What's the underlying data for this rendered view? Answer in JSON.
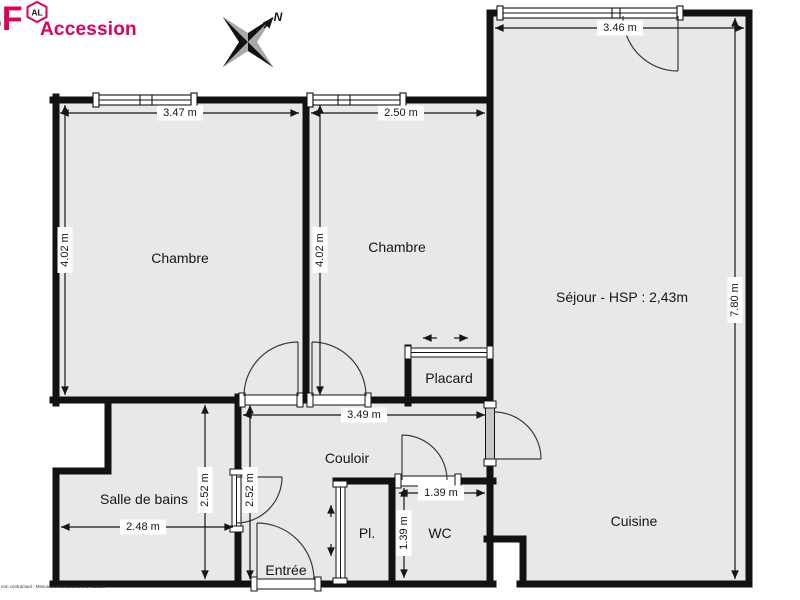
{
  "branding": {
    "logo_main": "3F",
    "badge_text": "AL",
    "subtitle": "Accession",
    "brand_color": "#e0005a"
  },
  "compass": {
    "north_label": "N"
  },
  "footnote": "non contractuel - Mesures et surfaces à titre indicatif",
  "rooms": {
    "chambre1": {
      "label": "Chambre"
    },
    "chambre2": {
      "label": "Chambre"
    },
    "sejour": {
      "label": "Séjour - HSP : 2,43m"
    },
    "placard": {
      "label": "Placard"
    },
    "couloir": {
      "label": "Couloir"
    },
    "sdb": {
      "label": "Salle de bains"
    },
    "entree": {
      "label": "Entrée"
    },
    "pl": {
      "label": "Pl."
    },
    "wc": {
      "label": "WC"
    },
    "cuisine": {
      "label": "Cuisine"
    }
  },
  "dimensions": {
    "chambre1_width": {
      "label": "3.47 m"
    },
    "chambre1_height": {
      "label": "4.02 m"
    },
    "chambre2_width": {
      "label": "2.50 m"
    },
    "chambre2_height": {
      "label": "4.02 m"
    },
    "sejour_width": {
      "label": "3.46 m"
    },
    "sejour_height": {
      "label": "7.80 m"
    },
    "couloir_width": {
      "label": "3.49 m"
    },
    "sdb_width": {
      "label": "2.48 m"
    },
    "sdb_height": {
      "label": "2.52 m"
    },
    "hall_height": {
      "label": "2.52 m"
    },
    "wc_width": {
      "label": "1.39 m"
    },
    "wc_height": {
      "label": "1.39 m"
    }
  },
  "colors": {
    "room_fill": "#e8e8e8",
    "wall": "#121212"
  }
}
